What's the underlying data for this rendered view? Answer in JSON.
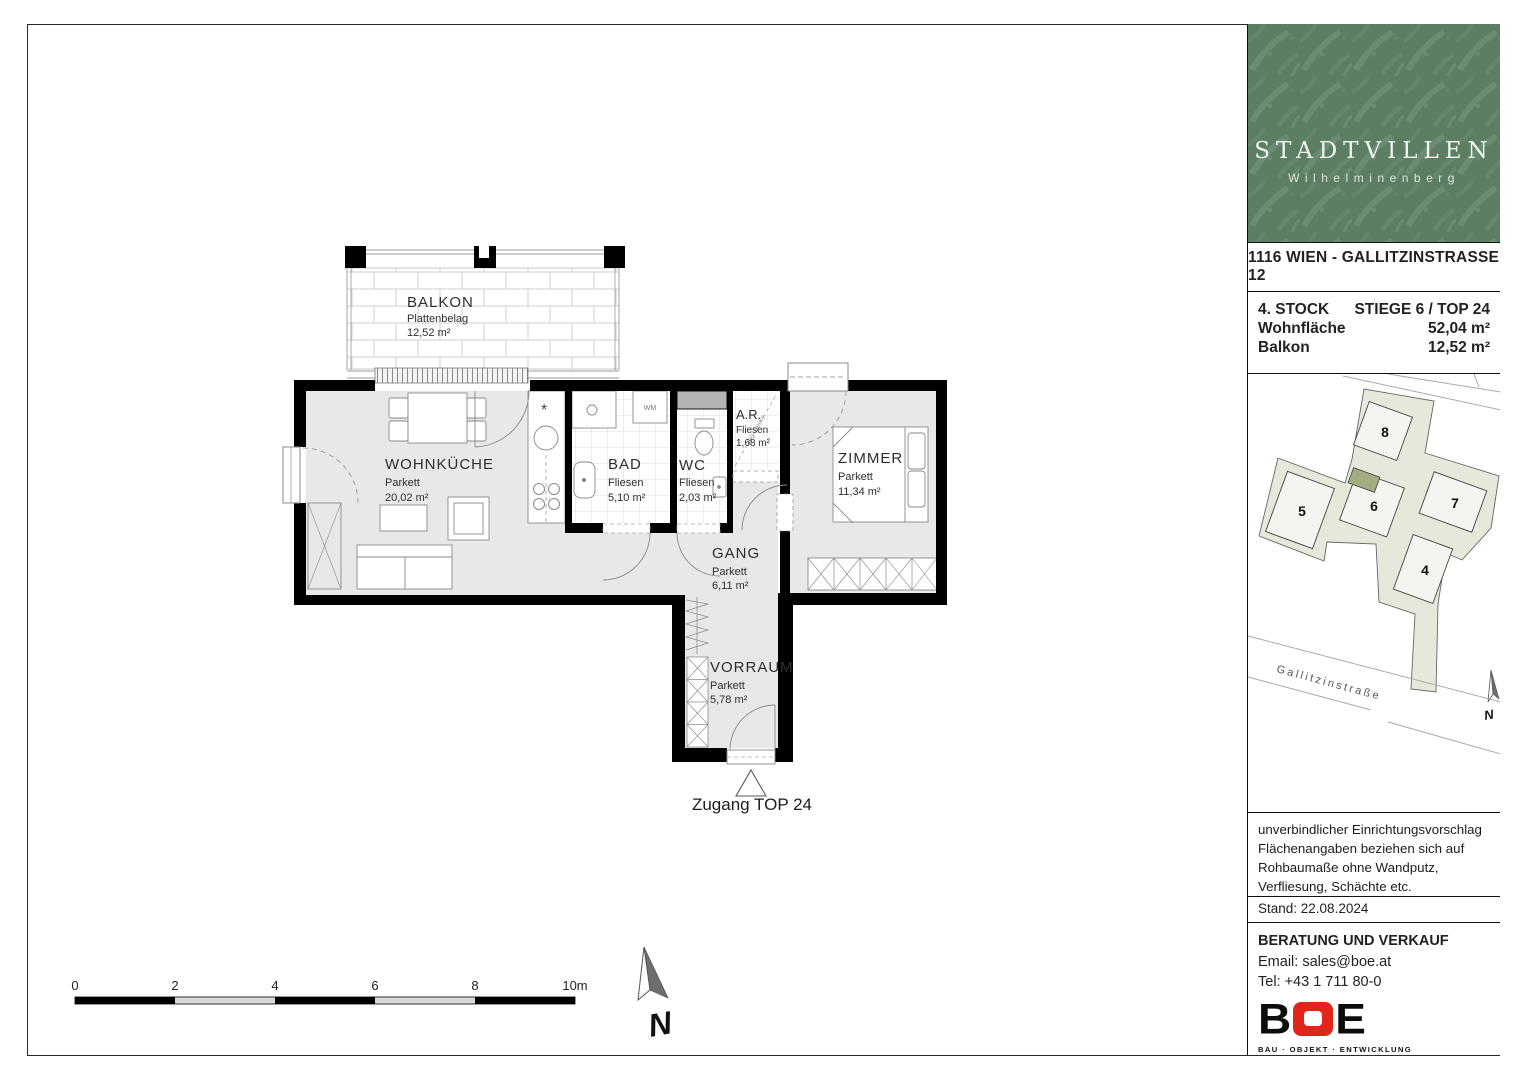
{
  "colors": {
    "wall": "#000000",
    "floor_gray": "#e8e8e8",
    "logo_green": "#5c7f64",
    "logo_leaf": "#76977d",
    "site_plot": "#e6e8dc",
    "site_building": "#f4f4f0",
    "site_highlight": "#a3ad82",
    "boe_red": "#e1251b"
  },
  "plan": {
    "rooms": [
      {
        "name": "BALKON",
        "floor": "Plattenbelag",
        "area": "12,52 m²"
      },
      {
        "name": "WOHNKÜCHE",
        "floor": "Parkett",
        "area": "20,02 m²"
      },
      {
        "name": "BAD",
        "floor": "Fliesen",
        "area": "5,10 m²"
      },
      {
        "name": "WC",
        "floor": "Fliesen",
        "area": "2,03 m²"
      },
      {
        "name": "A.R.",
        "floor": "Fliesen",
        "area": "1,68 m²"
      },
      {
        "name": "ZIMMER",
        "floor": "Parkett",
        "area": "11,34 m²"
      },
      {
        "name": "GANG",
        "floor": "Parkett",
        "area": "6,11 m²"
      },
      {
        "name": "VORRAUM",
        "floor": "Parkett",
        "area": "5,78 m²"
      }
    ],
    "entrance_label": "Zugang TOP 24",
    "wm_label": "WM",
    "kitchen_marker": "*",
    "ar_ceiling_note": "abg. Decke",
    "scale": [
      "0",
      "2",
      "4",
      "6",
      "8",
      "10m"
    ],
    "north": "N"
  },
  "sidebar": {
    "logo": {
      "title": "STADTVILLEN",
      "subtitle": "Wilhelminenberg"
    },
    "address": "1116 WIEN - GALLITZINSTRASSE 12",
    "unit": {
      "rows": [
        {
          "label": "4. STOCK",
          "value": "STIEGE 6 / TOP 24"
        },
        {
          "label": "Wohnfläche",
          "value": "52,04 m²"
        },
        {
          "label": "Balkon",
          "value": "12,52 m²"
        }
      ]
    },
    "siteplan": {
      "buildings": [
        "4",
        "5",
        "6",
        "7",
        "8"
      ],
      "street": "Gallitzinstraße",
      "north": "N"
    },
    "disclaimer": [
      "unverbindlicher Einrichtungsvorschlag",
      "Flächenangaben beziehen sich auf",
      "Rohbaumaße ohne Wandputz,",
      "Verfliesung, Schächte etc."
    ],
    "stand": "Stand: 22.08.2024",
    "contact": {
      "heading": "BERATUNG UND VERKAUF",
      "email": "Email: sales@boe.at",
      "tel": "Tel: +43 1 711 80-0"
    },
    "boe": {
      "left": "B",
      "right": "E",
      "tagline": "BAU · OBJEKT · ENTWICKLUNG"
    }
  }
}
